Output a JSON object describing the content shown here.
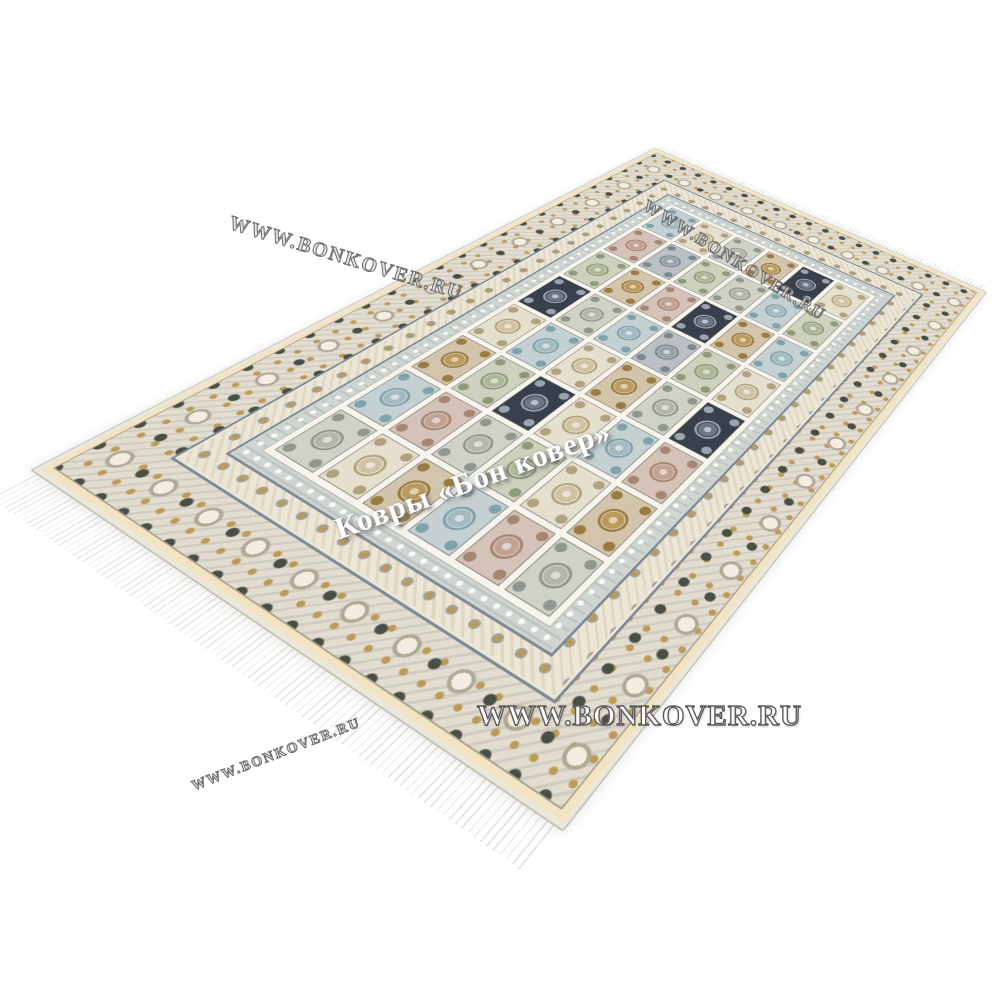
{
  "page": {
    "background": "#ffffff"
  },
  "watermarks": {
    "top_left": "WWW.BONKOVER.RU",
    "top_right": "WWW.BONKOVER.RU",
    "center": "Ковры «Бон ковер»",
    "bottom_center": "WWW.BONKOVER.RU",
    "bottom_left": "WWW.BONKOVER.RU",
    "fill_color": "#ffffff",
    "outline_color": "#5f5f5f"
  },
  "rug": {
    "colors": {
      "outer_edge": "#eae8dd",
      "outer_line": "#c6c1b0",
      "kilim_band": "#f2e4c2",
      "main_border_bg": "#e3ddcf",
      "rosette_light": "#f2ede0",
      "rosette_ring": "#b0a995",
      "dark_accent": "#4a4f46",
      "gold_accent": "#bd9a57",
      "guard_line": "#7e8a96",
      "secondary_bg": "#ece6d7",
      "inner_band_bg": "#cfd5d1",
      "field_margin": "#f6f4ec",
      "grid_line": "#f6f4ec",
      "fringe_white": "#ffffff",
      "fringe_shade": "#e4e2db"
    },
    "field": {
      "rows": 6,
      "cols": 8,
      "panel_palette": {
        "grey": {
          "bg": "#d0d1c7",
          "med": "#b4b6aa",
          "ring": "#8f978f"
        },
        "blue": {
          "bg": "#c5d0d3",
          "med": "#a4bac0",
          "ring": "#7fa2ab"
        },
        "tan": {
          "bg": "#d3c5ab",
          "med": "#bb9a5c",
          "ring": "#9a7b42"
        },
        "cream": {
          "bg": "#e5dfcd",
          "med": "#cfc3a4",
          "ring": "#b0a27f"
        },
        "rose": {
          "bg": "#d5c2b8",
          "med": "#c1a293",
          "ring": "#a58672"
        },
        "sage": {
          "bg": "#cdd1bd",
          "med": "#aeb698",
          "ring": "#8e9a7a"
        },
        "navy": {
          "bg": "#39404b",
          "med": "#6e7785",
          "ring": "#9aa3ae"
        },
        "slate": {
          "bg": "#b9bfc2",
          "med": "#98a2a8",
          "ring": "#7c8890"
        }
      },
      "panels": [
        "grey",
        "blue",
        "tan",
        "cream",
        "navy",
        "sage",
        "rose",
        "blue",
        "cream",
        "rose",
        "sage",
        "blue",
        "grey",
        "tan",
        "slate",
        "cream",
        "tan",
        "grey",
        "navy",
        "cream",
        "blue",
        "rose",
        "sage",
        "grey",
        "blue",
        "sage",
        "cream",
        "tan",
        "slate",
        "navy",
        "grey",
        "tan",
        "rose",
        "cream",
        "blue",
        "grey",
        "sage",
        "tan",
        "blue",
        "navy",
        "grey",
        "tan",
        "rose",
        "navy",
        "cream",
        "blue",
        "sage",
        "cream"
      ]
    }
  }
}
